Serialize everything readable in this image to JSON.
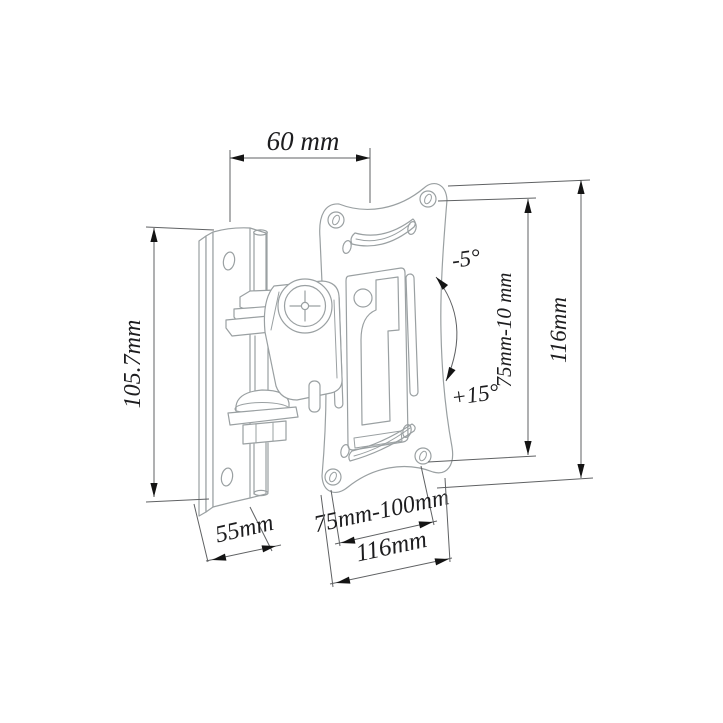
{
  "meta": {
    "title": "Tilting TV wall-mount bracket — dimension drawing",
    "drawing_type": "technical line drawing"
  },
  "colors": {
    "bg": "#ffffff",
    "draw": "#9aa0a2",
    "dim": "#5f6163",
    "arrow": "#141414",
    "ink": "#1d1d1f"
  },
  "dimensions": {
    "top_width": "60 mm",
    "wall_plate_height": "105.7mm",
    "wall_plate_depth": "55mm",
    "vesa_pattern_width": "75mm-100mm",
    "plate_width_bottom": "116mm",
    "vesa_pattern_height": "75mm-10 mm",
    "plate_height_right": "116mm",
    "tilt_up": "-5°",
    "tilt_down": "+15°"
  }
}
